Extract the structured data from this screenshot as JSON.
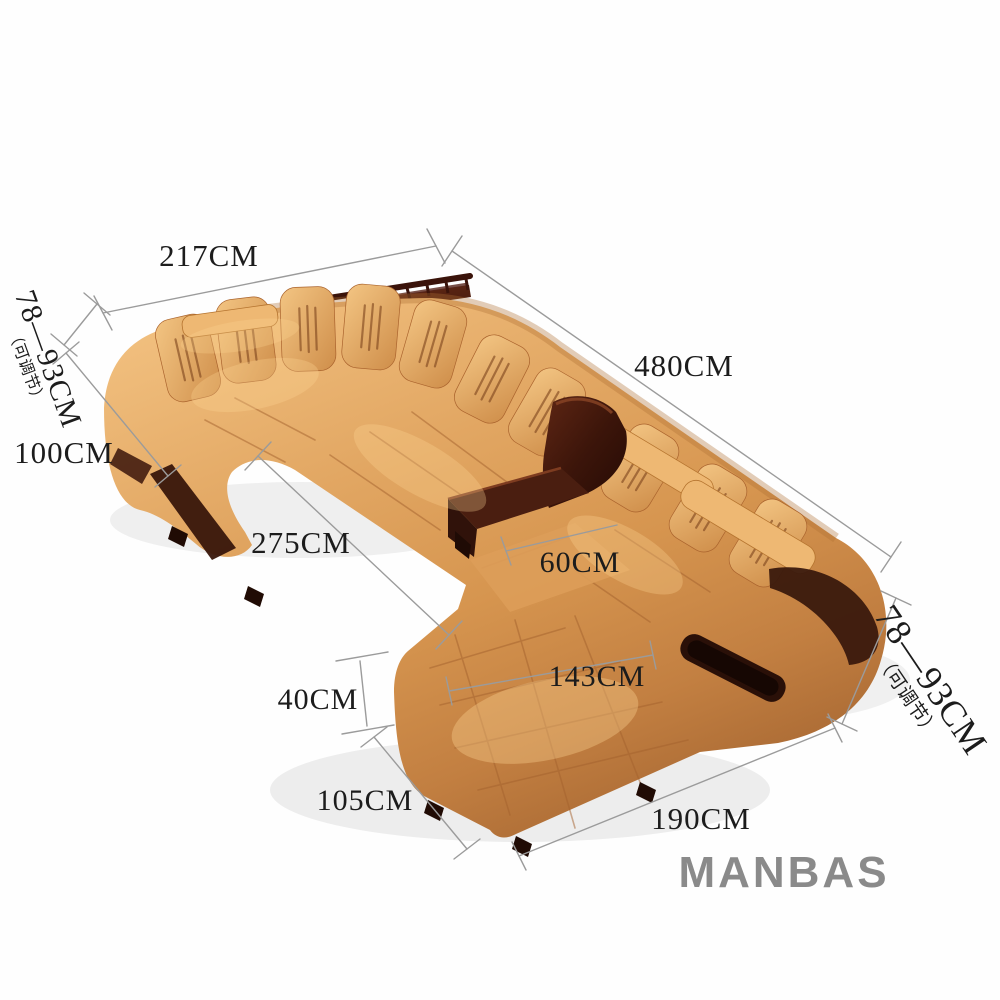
{
  "page": {
    "background": "#fefefe",
    "type": "product-dimension-diagram"
  },
  "brand": {
    "label": "MANBAS",
    "color": "#8a8a8a"
  },
  "illustration": {
    "subject": "U-shaped leather sectional sofa with wooden back shelf, waterfall console table, ottoman and chaise lounge",
    "leather_color": "#d6954f",
    "leather_highlight": "#f1bf7e",
    "leather_shadow": "#aa6a34",
    "wood_color": "#3c150a",
    "dimension_line_color": "#9b9b9b",
    "dimension_text_color": "#1c1c1c"
  },
  "dimensions": {
    "back_width": "217CM",
    "total_length": "480CM",
    "left_depth": "100CM",
    "straight_section": "275CM",
    "ottoman_depth": "60CM",
    "chaise_length": "143CM",
    "chaise_height": "40CM",
    "chaise_width": "105CM",
    "right_section_length": "190CM",
    "back_height_range": "78—93CM",
    "back_height_note": "（可调节）"
  }
}
